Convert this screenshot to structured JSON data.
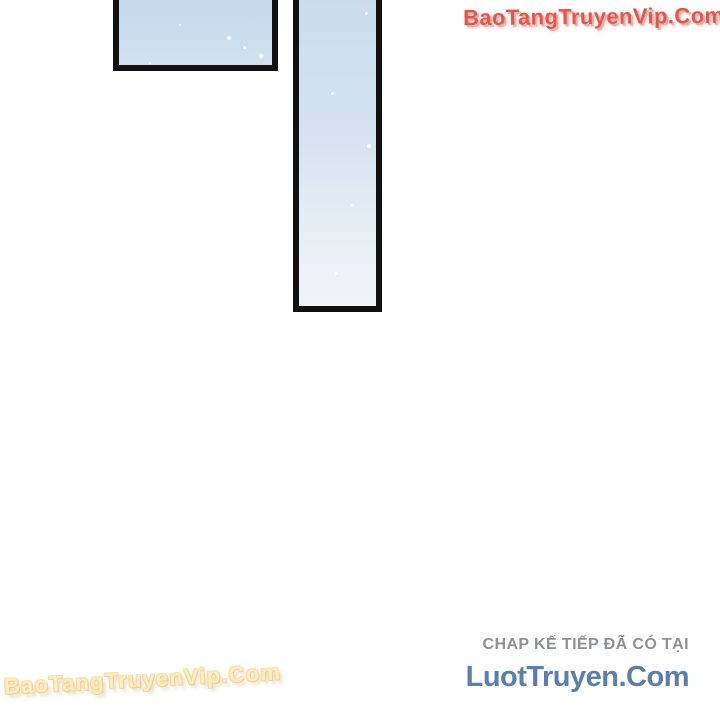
{
  "page": {
    "background_color": "#ffffff"
  },
  "watermarks": {
    "top_right": {
      "text": "BaoTangTruyenVip.Com",
      "color": "#e2574d",
      "shadow_color": "#f2ada6"
    },
    "bottom_left": {
      "text": "BaoTangTruyenVip.Com",
      "color": "#fcedbd",
      "outline_color": "#eccf97"
    }
  },
  "comic": {
    "panel_small": {
      "border_color": "#111111",
      "fill_top_color": "#c4d8eb",
      "fill_bottom_color": "#d3e2ef"
    },
    "panel_tall": {
      "border_color": "#111111",
      "fill_top_color": "#c9ddee",
      "fill_bottom_color": "#f0f4f6"
    }
  },
  "footer": {
    "next_chapter_note": "CHAP KẾ TIẾP ĐÃ CÓ TẠI",
    "note_color": "#8d9197",
    "site_name": "LuotTruyen.Com",
    "site_color": "#5a7eae"
  }
}
